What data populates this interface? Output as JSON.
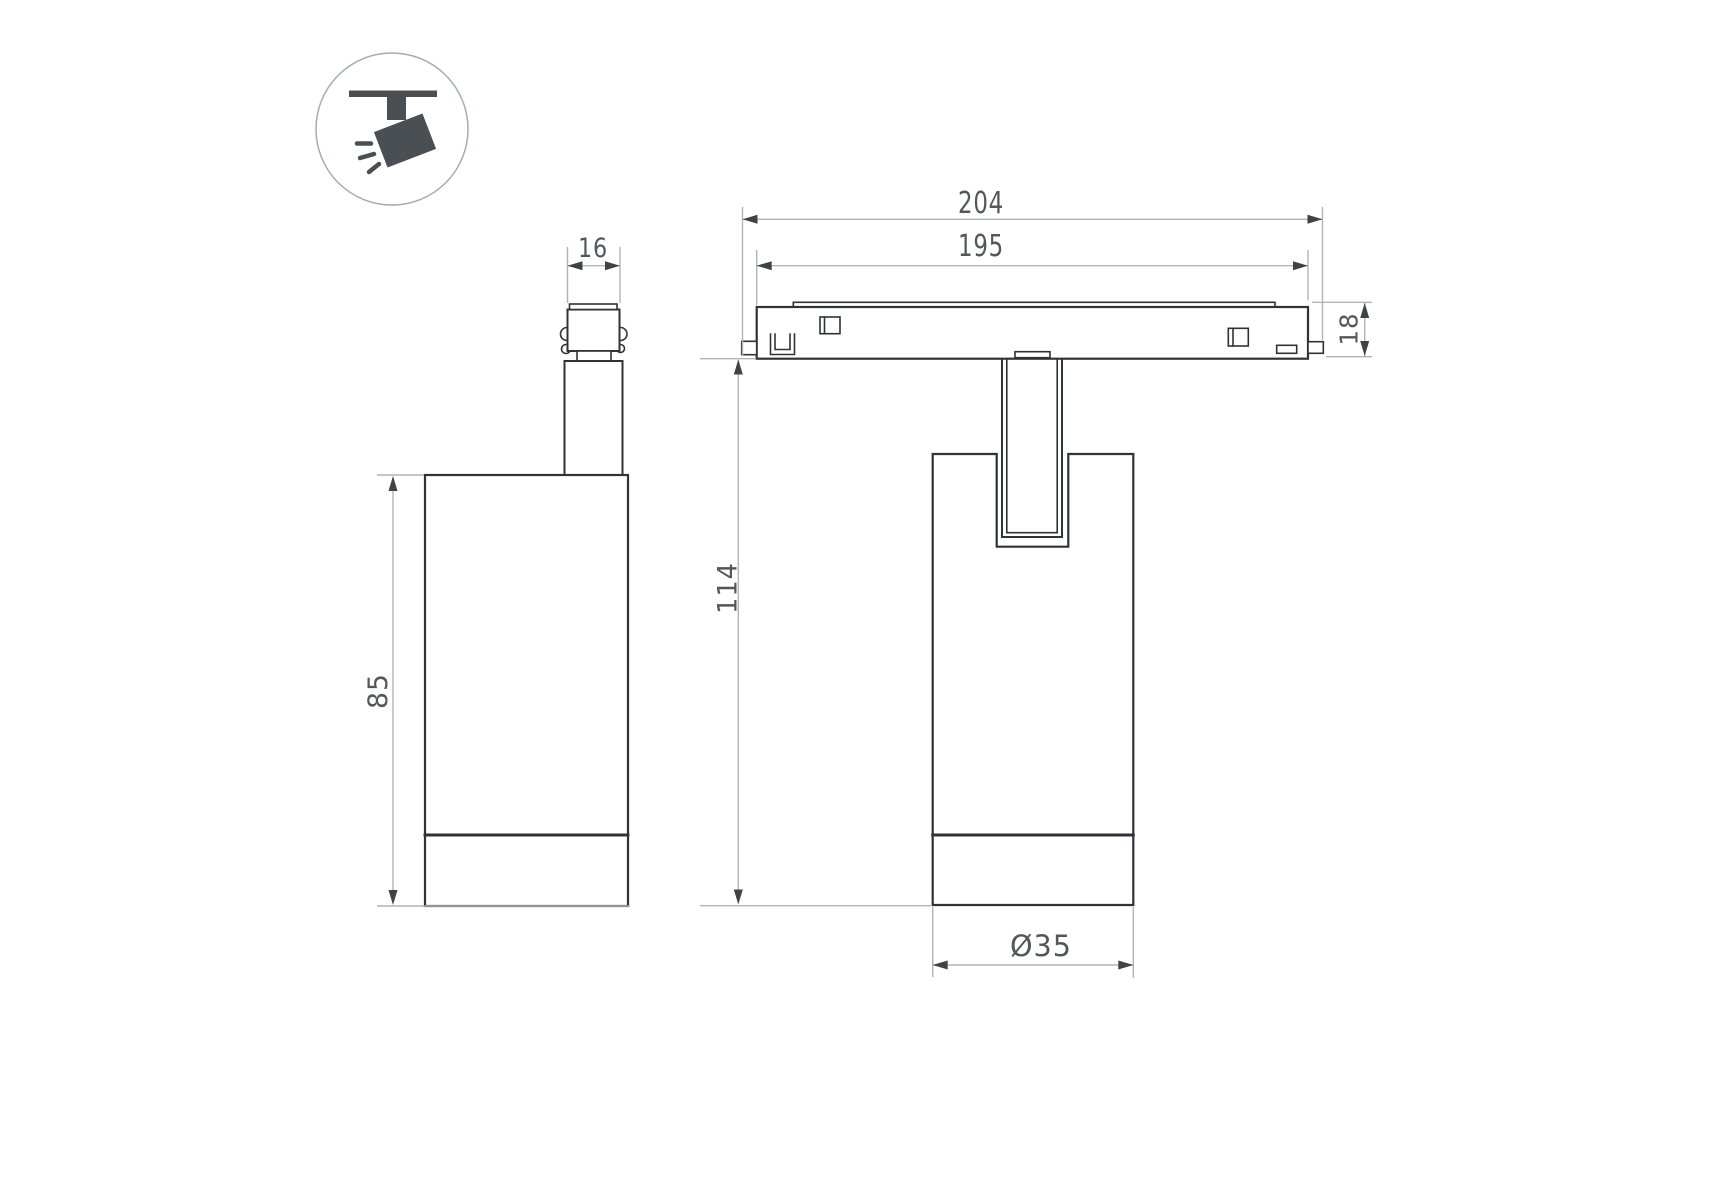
{
  "drawing": {
    "title": "track-spotlight-dimension-drawing",
    "views": {
      "side_view": "side-view-of-spotlight",
      "front_view": "front-view-on-magnetic-track",
      "icon": "ceiling-track-spotlight-pictogram"
    },
    "dimensions": {
      "adapter_width": "16",
      "body_height": "85",
      "track_length_overall": "204",
      "track_length_inner": "195",
      "track_height": "18",
      "fixture_height": "114",
      "body_diameter": "Ø35"
    },
    "colors": {
      "background": "#ffffff",
      "outline": "#2f3338",
      "dim": "#b0b4b7",
      "arrow": "#3e4347",
      "text": "#53575c",
      "icon": "#4a4f54"
    }
  }
}
